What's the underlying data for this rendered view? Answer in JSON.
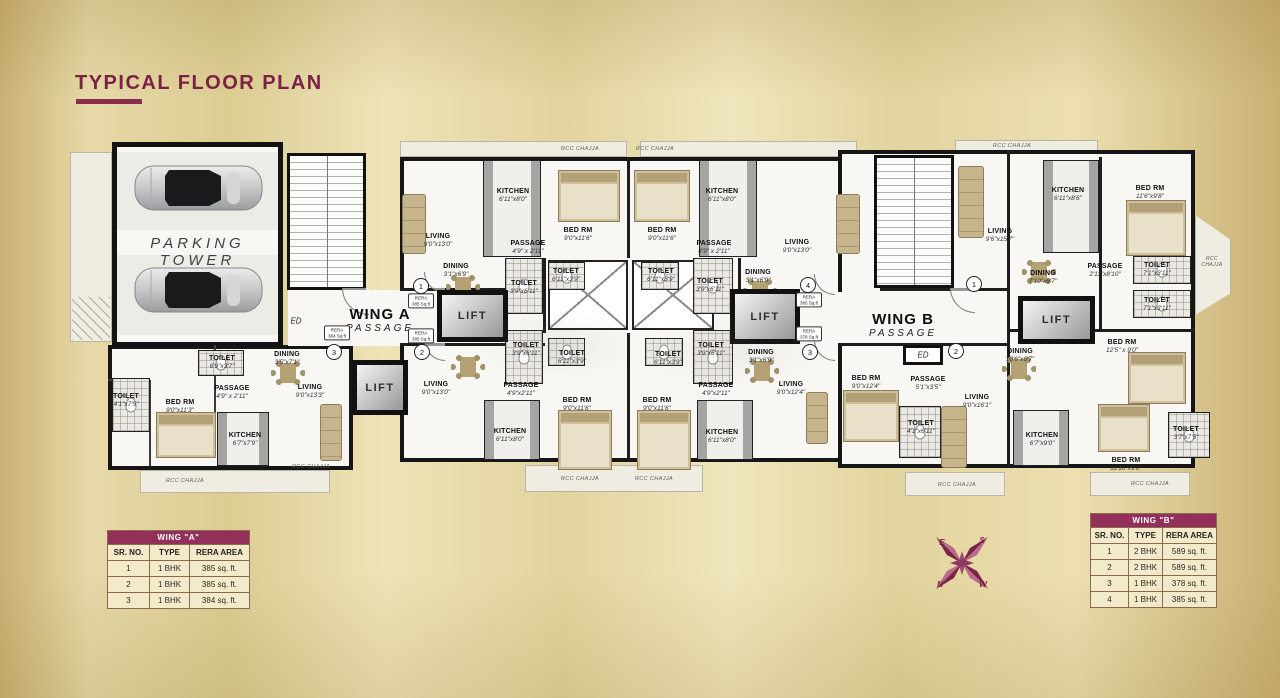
{
  "title": "TYPICAL FLOOR PLAN",
  "plan": {
    "parking_label": "PARKING TOWER",
    "wing_a": {
      "name": "WING A",
      "passage": "PASSAGE",
      "ed": "ED"
    },
    "wing_b": {
      "name": "WING B",
      "passage": "PASSAGE",
      "ed": "ED"
    },
    "lift": "LIFT",
    "chajja": "RCC CHAJJA",
    "units": [
      "1",
      "2",
      "3",
      "4",
      "3",
      "2",
      "1"
    ],
    "rera": [
      {
        "t": "RERA",
        "a": "385 Sq.ft"
      },
      {
        "t": "RERA",
        "a": "385 Sq.ft"
      },
      {
        "t": "RERA",
        "a": "384 Sq.ft"
      },
      {
        "t": "RERA",
        "a": "385 Sq.ft"
      },
      {
        "t": "RERA",
        "a": "378 Sq.ft"
      }
    ],
    "rooms": [
      {
        "n": "LIVING",
        "d": "9'0\"x13'0\""
      },
      {
        "n": "KITCHEN",
        "d": "6'11\"x8'0\""
      },
      {
        "n": "PASSAGE",
        "d": "4'9\" x 2'11\""
      },
      {
        "n": "BED RM",
        "d": "9'0\"x11'6\""
      },
      {
        "n": "DINING",
        "d": "3'1\"x6'9\""
      },
      {
        "n": "TOILET",
        "d": "3'9\"x6'11\""
      },
      {
        "n": "TOILET",
        "d": "6'11\"x3'9\""
      },
      {
        "n": "BED RM",
        "d": "9'0\"x11'6\""
      },
      {
        "n": "KITCHEN",
        "d": "6'11\"x8'0\""
      },
      {
        "n": "PASSAGE",
        "d": "4'9\" x 2'11\""
      },
      {
        "n": "LIVING",
        "d": "9'0\"x13'0\""
      },
      {
        "n": "TOILET",
        "d": "6'11\"x3'9\""
      },
      {
        "n": "TOILET",
        "d": "3'9\"x6'11\""
      },
      {
        "n": "DINING",
        "d": "3'1\"x6'9\""
      },
      {
        "n": "TOILET",
        "d": "3'9\"x6'11\""
      },
      {
        "n": "TOILET",
        "d": "6'11\"x3'9\""
      },
      {
        "n": "TOILET",
        "d": "6'11\"x3'9\""
      },
      {
        "n": "TOILET",
        "d": "3'9\"x6'11\""
      },
      {
        "n": "LIVING",
        "d": "9'0\"x13'0\""
      },
      {
        "n": "PASSAGE",
        "d": "4'9\"x2'11\""
      },
      {
        "n": "KITCHEN",
        "d": "6'11\"x8'0\""
      },
      {
        "n": "BED RM",
        "d": "9'0\"x11'6\""
      },
      {
        "n": "BED RM",
        "d": "9'0\"x11'6\""
      },
      {
        "n": "PASSAGE",
        "d": "4'9\"x2'11\""
      },
      {
        "n": "DINING",
        "d": "3'1\"x6'9\""
      },
      {
        "n": "KITCHEN",
        "d": "6'11\"x8'0\""
      },
      {
        "n": "LIVING",
        "d": "9'0\"x12'4\""
      },
      {
        "n": "TOILET",
        "d": "6'9\"x3'7\""
      },
      {
        "n": "DINING",
        "d": "3'5\"x7'1\""
      },
      {
        "n": "TOILET",
        "d": "4'1\"x7'5\""
      },
      {
        "n": "BED RM",
        "d": "9'0\"x11'3\""
      },
      {
        "n": "PASSAGE",
        "d": "4'9\" x 2'11\""
      },
      {
        "n": "KITCHEN",
        "d": "6'7\"x7'9\""
      },
      {
        "n": "LIVING",
        "d": "9'0\"x13'3\""
      },
      {
        "n": "LIVING",
        "d": "9'6\"x15'7\""
      },
      {
        "n": "KITCHEN",
        "d": "6'11\"x8'6\""
      },
      {
        "n": "BED RM",
        "d": "11'6\"x9'8\""
      },
      {
        "n": "DINING",
        "d": "7'10\"x6'7\""
      },
      {
        "n": "PASSAGE",
        "d": "2'11\"x8'10\""
      },
      {
        "n": "TOILET",
        "d": "7'1\"x3'11\""
      },
      {
        "n": "TOILET",
        "d": "7'1\"x3'11\""
      },
      {
        "n": "BED RM",
        "d": "9'0\"x12'4\""
      },
      {
        "n": "PASSAGE",
        "d": "5'1\"x3'5\""
      },
      {
        "n": "TOILET",
        "d": "4'1\"x6'11\""
      },
      {
        "n": "LIVING",
        "d": "9'0\"x16'1\""
      },
      {
        "n": "DINING",
        "d": "10'6\"x6'7\""
      },
      {
        "n": "KITCHEN",
        "d": "6'7\"x9'0\""
      },
      {
        "n": "BED RM",
        "d": "12'5\" x 9'0\""
      },
      {
        "n": "BED RM",
        "d": "11'10\"x9'0\""
      },
      {
        "n": "TOILET",
        "d": "3'7\"x7'5\""
      }
    ]
  },
  "tables": {
    "wing_a": {
      "title": "WING \"A\"",
      "columns": [
        "SR. NO.",
        "TYPE",
        "RERA AREA"
      ],
      "rows": [
        [
          "1",
          "1 BHK",
          "385 sq. ft."
        ],
        [
          "2",
          "1 BHK",
          "385 sq. ft."
        ],
        [
          "3",
          "1 BHK",
          "384 sq. ft."
        ]
      ]
    },
    "wing_b": {
      "title": "WING \"B\"",
      "columns": [
        "SR. NO.",
        "TYPE",
        "RERA AREA"
      ],
      "rows": [
        [
          "1",
          "2 BHK",
          "589 sq. ft."
        ],
        [
          "2",
          "2 BHK",
          "589 sq. ft."
        ],
        [
          "3",
          "1 BHK",
          "378 sq. ft."
        ],
        [
          "4",
          "1 BHK",
          "385 sq. ft."
        ]
      ]
    }
  },
  "compass": {
    "e": "E",
    "s": "S",
    "n": "N",
    "w": "W"
  }
}
